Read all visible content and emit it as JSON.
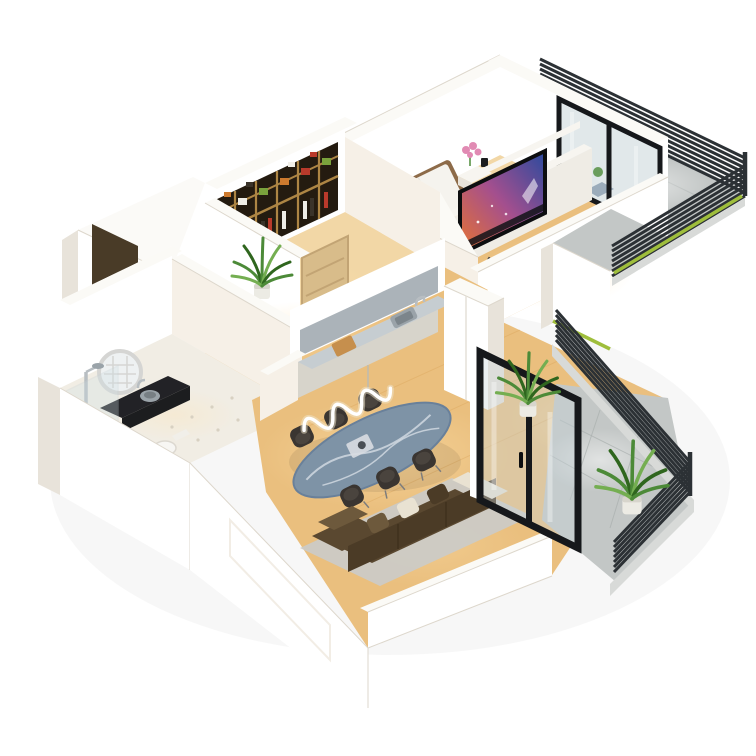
{
  "meta": {
    "title": "3D isometric apartment floor plan render",
    "render_type": "dollhouse cutaway, white background",
    "canvas": {
      "width": 756,
      "height": 756
    }
  },
  "rooms": [
    {
      "id": "bedroom-suite",
      "name": "Bedroom with TV lounge",
      "furniture": [
        "double bed with brown headboard",
        "white bedding and pillows",
        "two nightstands",
        "ball table lamp",
        "pink flower vase",
        "white media wall",
        "flat-screen TV playing colorful scene",
        "soundbar",
        "floating shelf",
        "cubby console"
      ]
    },
    {
      "id": "wardrobe-room",
      "name": "Walk-in wardrobe",
      "furniture": [
        "open closet with wooden dividers",
        "folded clothes in red, green, white and orange",
        "hanging garments",
        "leaning light-wood door",
        "potted plant"
      ]
    },
    {
      "id": "entry-hall",
      "name": "Entry hall",
      "furniture": [
        "dark brown entrance door with black handle",
        "potted plant",
        "wood strip flooring"
      ]
    },
    {
      "id": "bathroom",
      "name": "Bathroom",
      "furniture": [
        "walk-in shower with glass panel and chrome column",
        "black vanity counter",
        "round vessel sink",
        "round LED grid mirror",
        "toilet",
        "white tiled floor"
      ]
    },
    {
      "id": "kitchen-dining-living",
      "name": "Open kitchen / dining / living room",
      "furniture": [
        "kitchen counter with marble top",
        "mirror backsplash",
        "cutting board",
        "inset sink",
        "tall white cabinet",
        "oval blue-marble dining table",
        "six dark dining chairs",
        "white LED squiggle pendant",
        "brown corner sofa with cream end",
        "scatter cushions",
        "gray area rug"
      ]
    },
    {
      "id": "balcony-upper",
      "name": "Upper balcony",
      "furniture": [
        "black louvered slat railing",
        "black-framed glass doors",
        "marble bistro table",
        "wooden chair",
        "small potted plant",
        "gray tile floor",
        "green edge strip"
      ]
    },
    {
      "id": "balcony-lower",
      "name": "Lower balcony",
      "furniture": [
        "black louvered slat railing",
        "black-framed sliding glass door",
        "two potted palms in white pots",
        "gray tile floor"
      ]
    }
  ],
  "palette": {
    "wall": "#ffffff",
    "wallWarm": "#f6f0e7",
    "wallShade": "#e8e3da",
    "wallTop": "#fbfaf6",
    "wallEdge": "#ddd7cc",
    "woodFloor": "#eabf7e",
    "woodPale": "#f2d7a6",
    "woodDeep": "#d8a055",
    "glow": "#ffe3ae",
    "tileBath": "#f1ede4",
    "tileDot": "#d8d1c2",
    "balconyFloor": "#c3c7c6",
    "balconyLine": "#aab0af",
    "louver": "#2c3135",
    "ledge": "#d8dad8",
    "grass": "#9fbe3c",
    "frameBlack": "#16181b",
    "glass": "#c8d5d9",
    "bedHead": "#7a593c",
    "bedFrame": "#8d6b49",
    "linen": "#f5f3ee",
    "pillowGray": "#d4d7d9",
    "mediaWall": "#efece5",
    "shelfWhite": "#f7f5f0",
    "tvDark": "#121318",
    "tvScreenWarm": "#e8742f",
    "tvScreenMid": "#a44f8e",
    "tvScreenBlue": "#2a4a9e",
    "closetDark": "#241b10",
    "closetWood": "#ad8544",
    "clothesRed": "#b93a2b",
    "clothesGreen": "#7aa23c",
    "clothesWhite": "#f1efe8",
    "clothesOrange": "#cd7a2e",
    "clothesDark": "#3a332a",
    "doorWood": "#d8bc8a",
    "doorDark": "#493b27",
    "cabinet": "#d7d4cb",
    "counterMarble": "#c6cdd1",
    "backsplash": "#8f99a1",
    "board": "#c68f4d",
    "sink": "#9aa3a9",
    "tableMarble": "#7e93a6",
    "tableVein": "#e9eef2",
    "chairDark": "#3a3531",
    "sofa": "#5a4830",
    "sofaDark": "#4b3b26",
    "sofaLight": "#6d593c",
    "cream": "#e9e2d2",
    "rug": "#cbcbc8",
    "plant": "#4c8a38",
    "plantDark": "#2f661e",
    "plantLight": "#74ae51",
    "pot": "#ecebe4",
    "potShade": "#d7d5cc",
    "chrome": "#b8bec2",
    "dark": "#1c1d1f",
    "counterDark": "#222226",
    "mirror": "#eef1f2",
    "mirrorRing": "#d5d5d3",
    "flower": "#e18ab3",
    "lampWhite": "#ffffff"
  }
}
